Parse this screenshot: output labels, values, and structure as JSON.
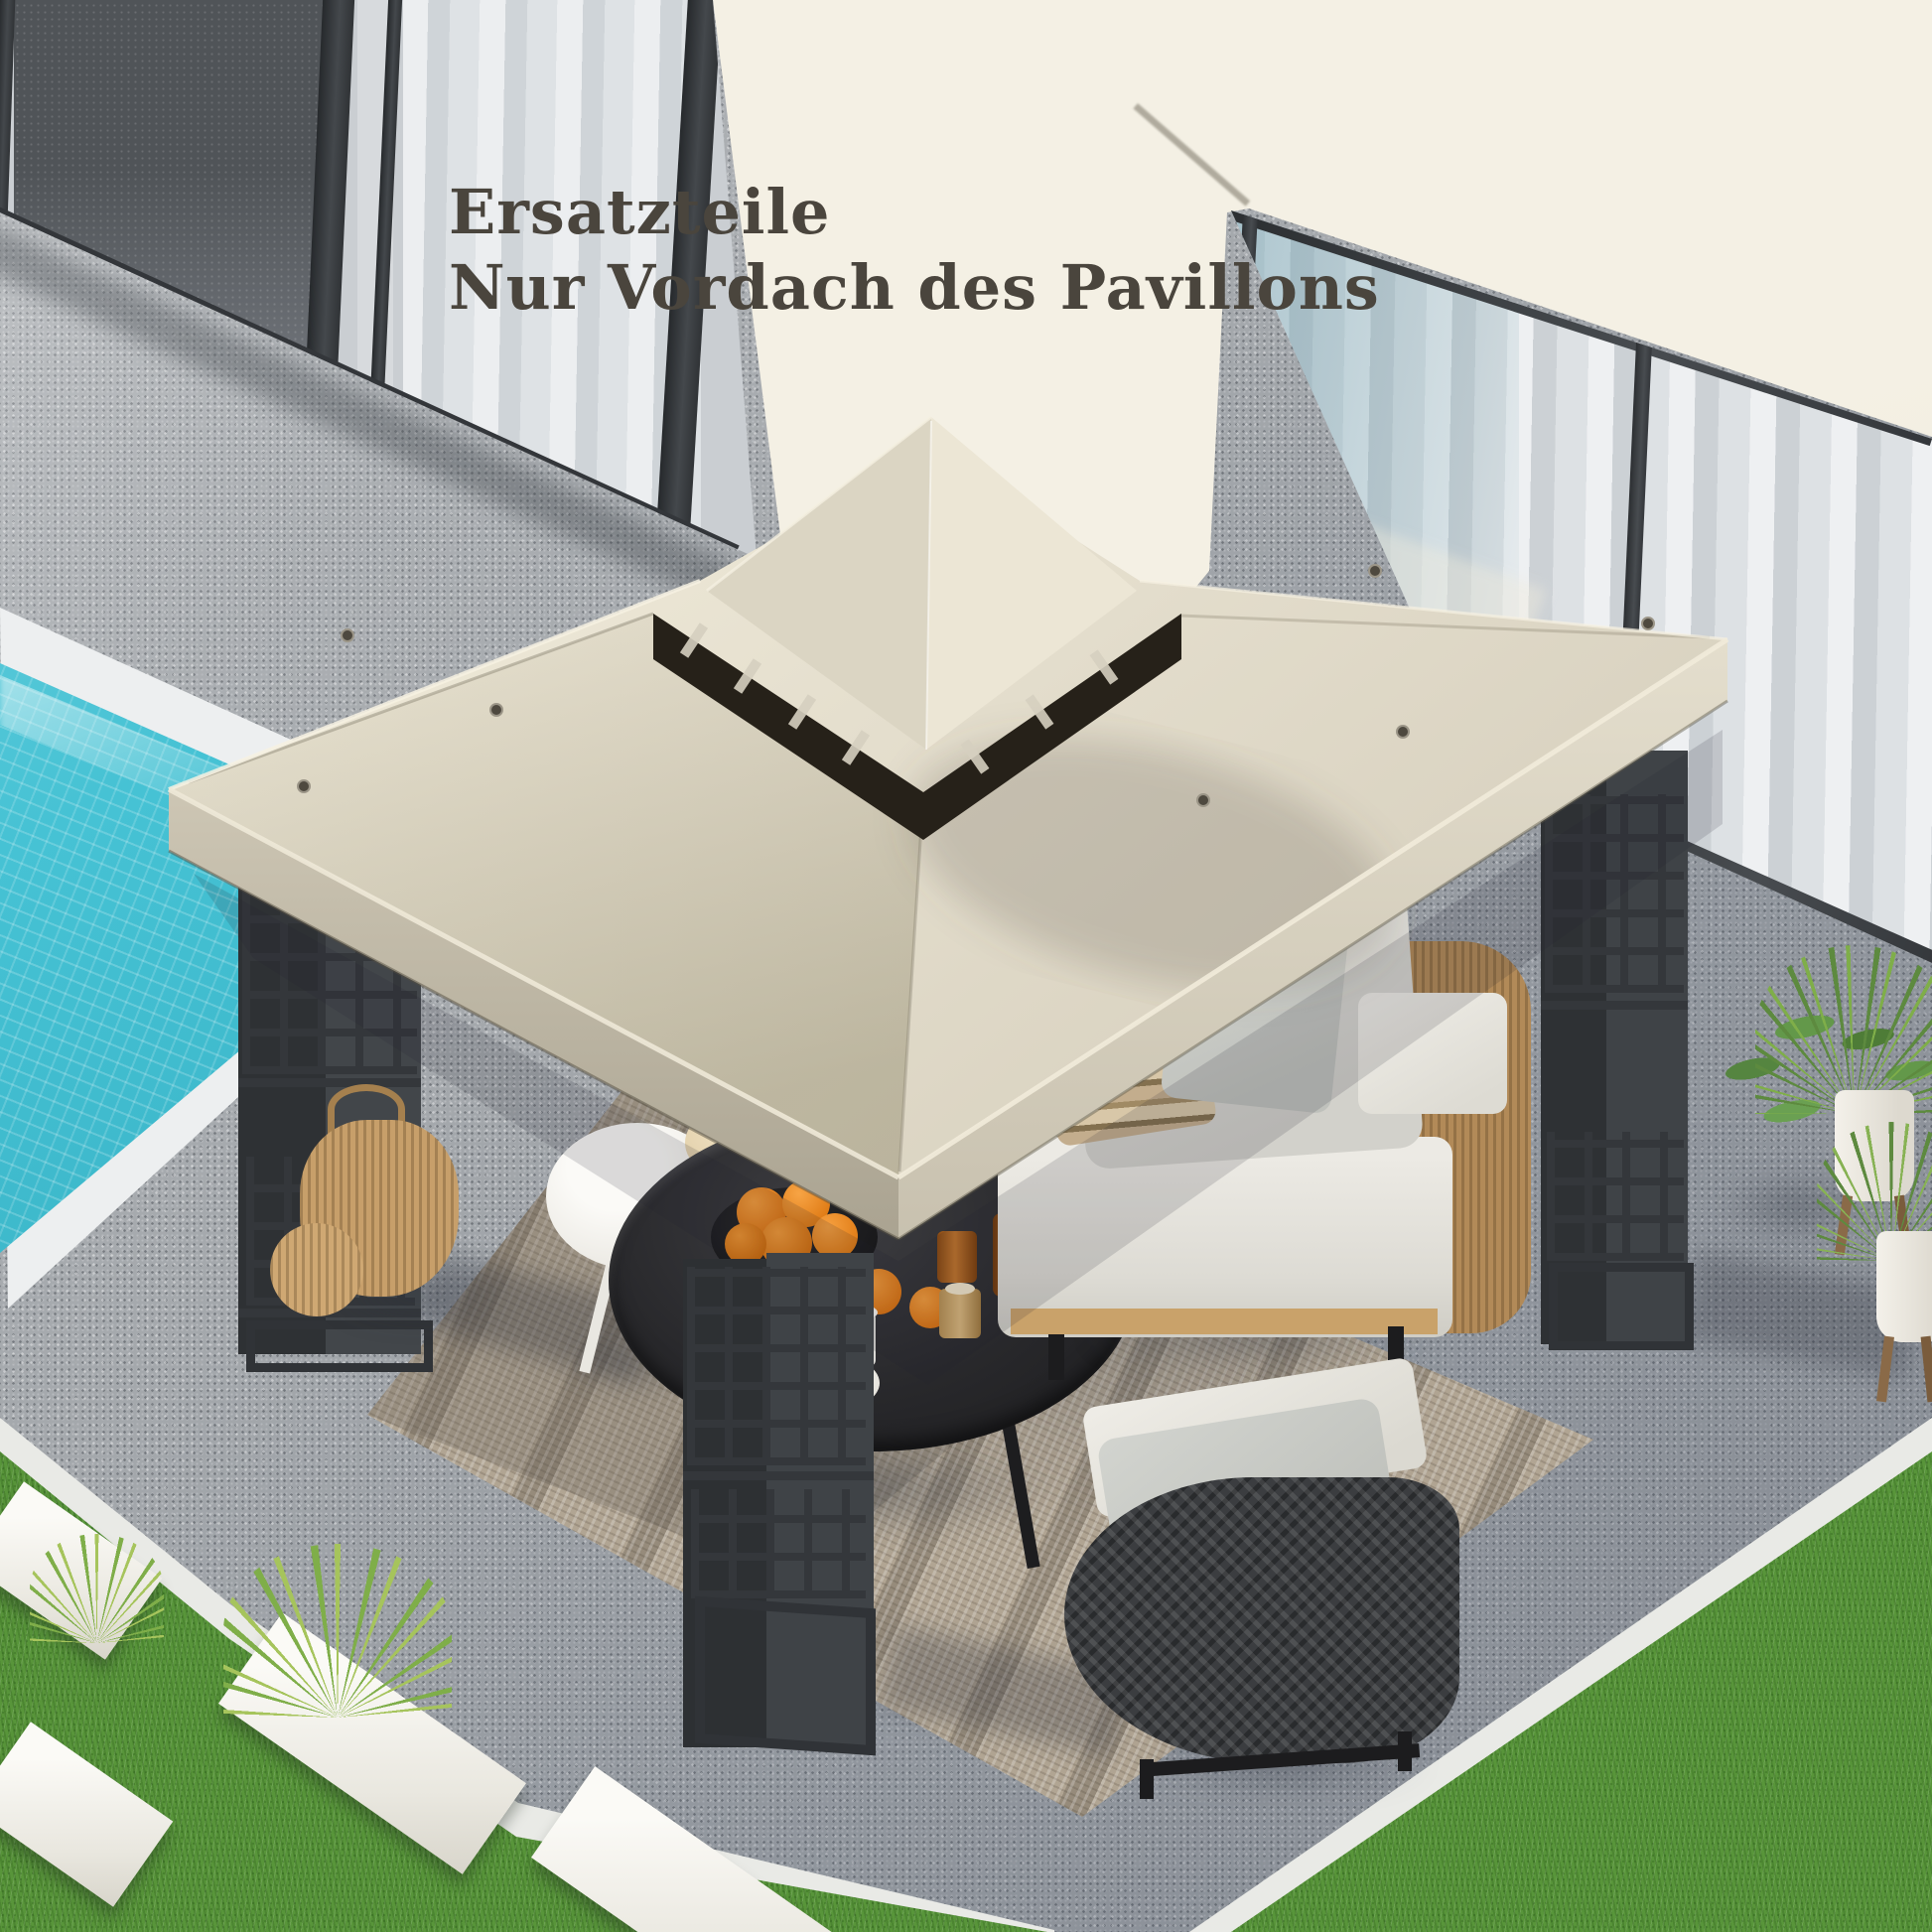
{
  "overlay": {
    "line1": "Ersatzteile",
    "line2": "Nur Vordach des Pavillons",
    "text_color": "#4a453d"
  },
  "palette": {
    "wall": "#f2eee2",
    "canopy_light": "#efe9d8",
    "canopy_mid": "#ddd6c4",
    "canopy_shadow": "#c0b9a7",
    "vent_dark": "#262119",
    "frame_metal": "#34373b",
    "pool_water": "#3db6c9",
    "pool_coping": "#edeff0",
    "gravel": "#a4a8ac",
    "grass": "#58953a",
    "rug": "#b1a593",
    "rattan": "#b28a58",
    "cushion_light": "#e7e6e1",
    "wicker_dark": "#3b3d40",
    "orange_fruit": "#e8831d",
    "curtain": "#dfe2e5"
  },
  "scene": {
    "description": "Overhead garden patio with two-tier beige gazebo canopy beside a pool; German caption advertises the replacement canopy roof only",
    "objects": [
      "glass-doors",
      "cream-wall",
      "picture-window",
      "swimming-pool",
      "gravel-patio",
      "lawn",
      "stepping-stones",
      "gazebo-canopy",
      "canopy-vent",
      "gazebo-posts",
      "outdoor-rug",
      "white-side-table",
      "black-tray-table",
      "oranges",
      "sofa",
      "wicker-armchair",
      "potted-plants",
      "rattan-lantern"
    ]
  }
}
